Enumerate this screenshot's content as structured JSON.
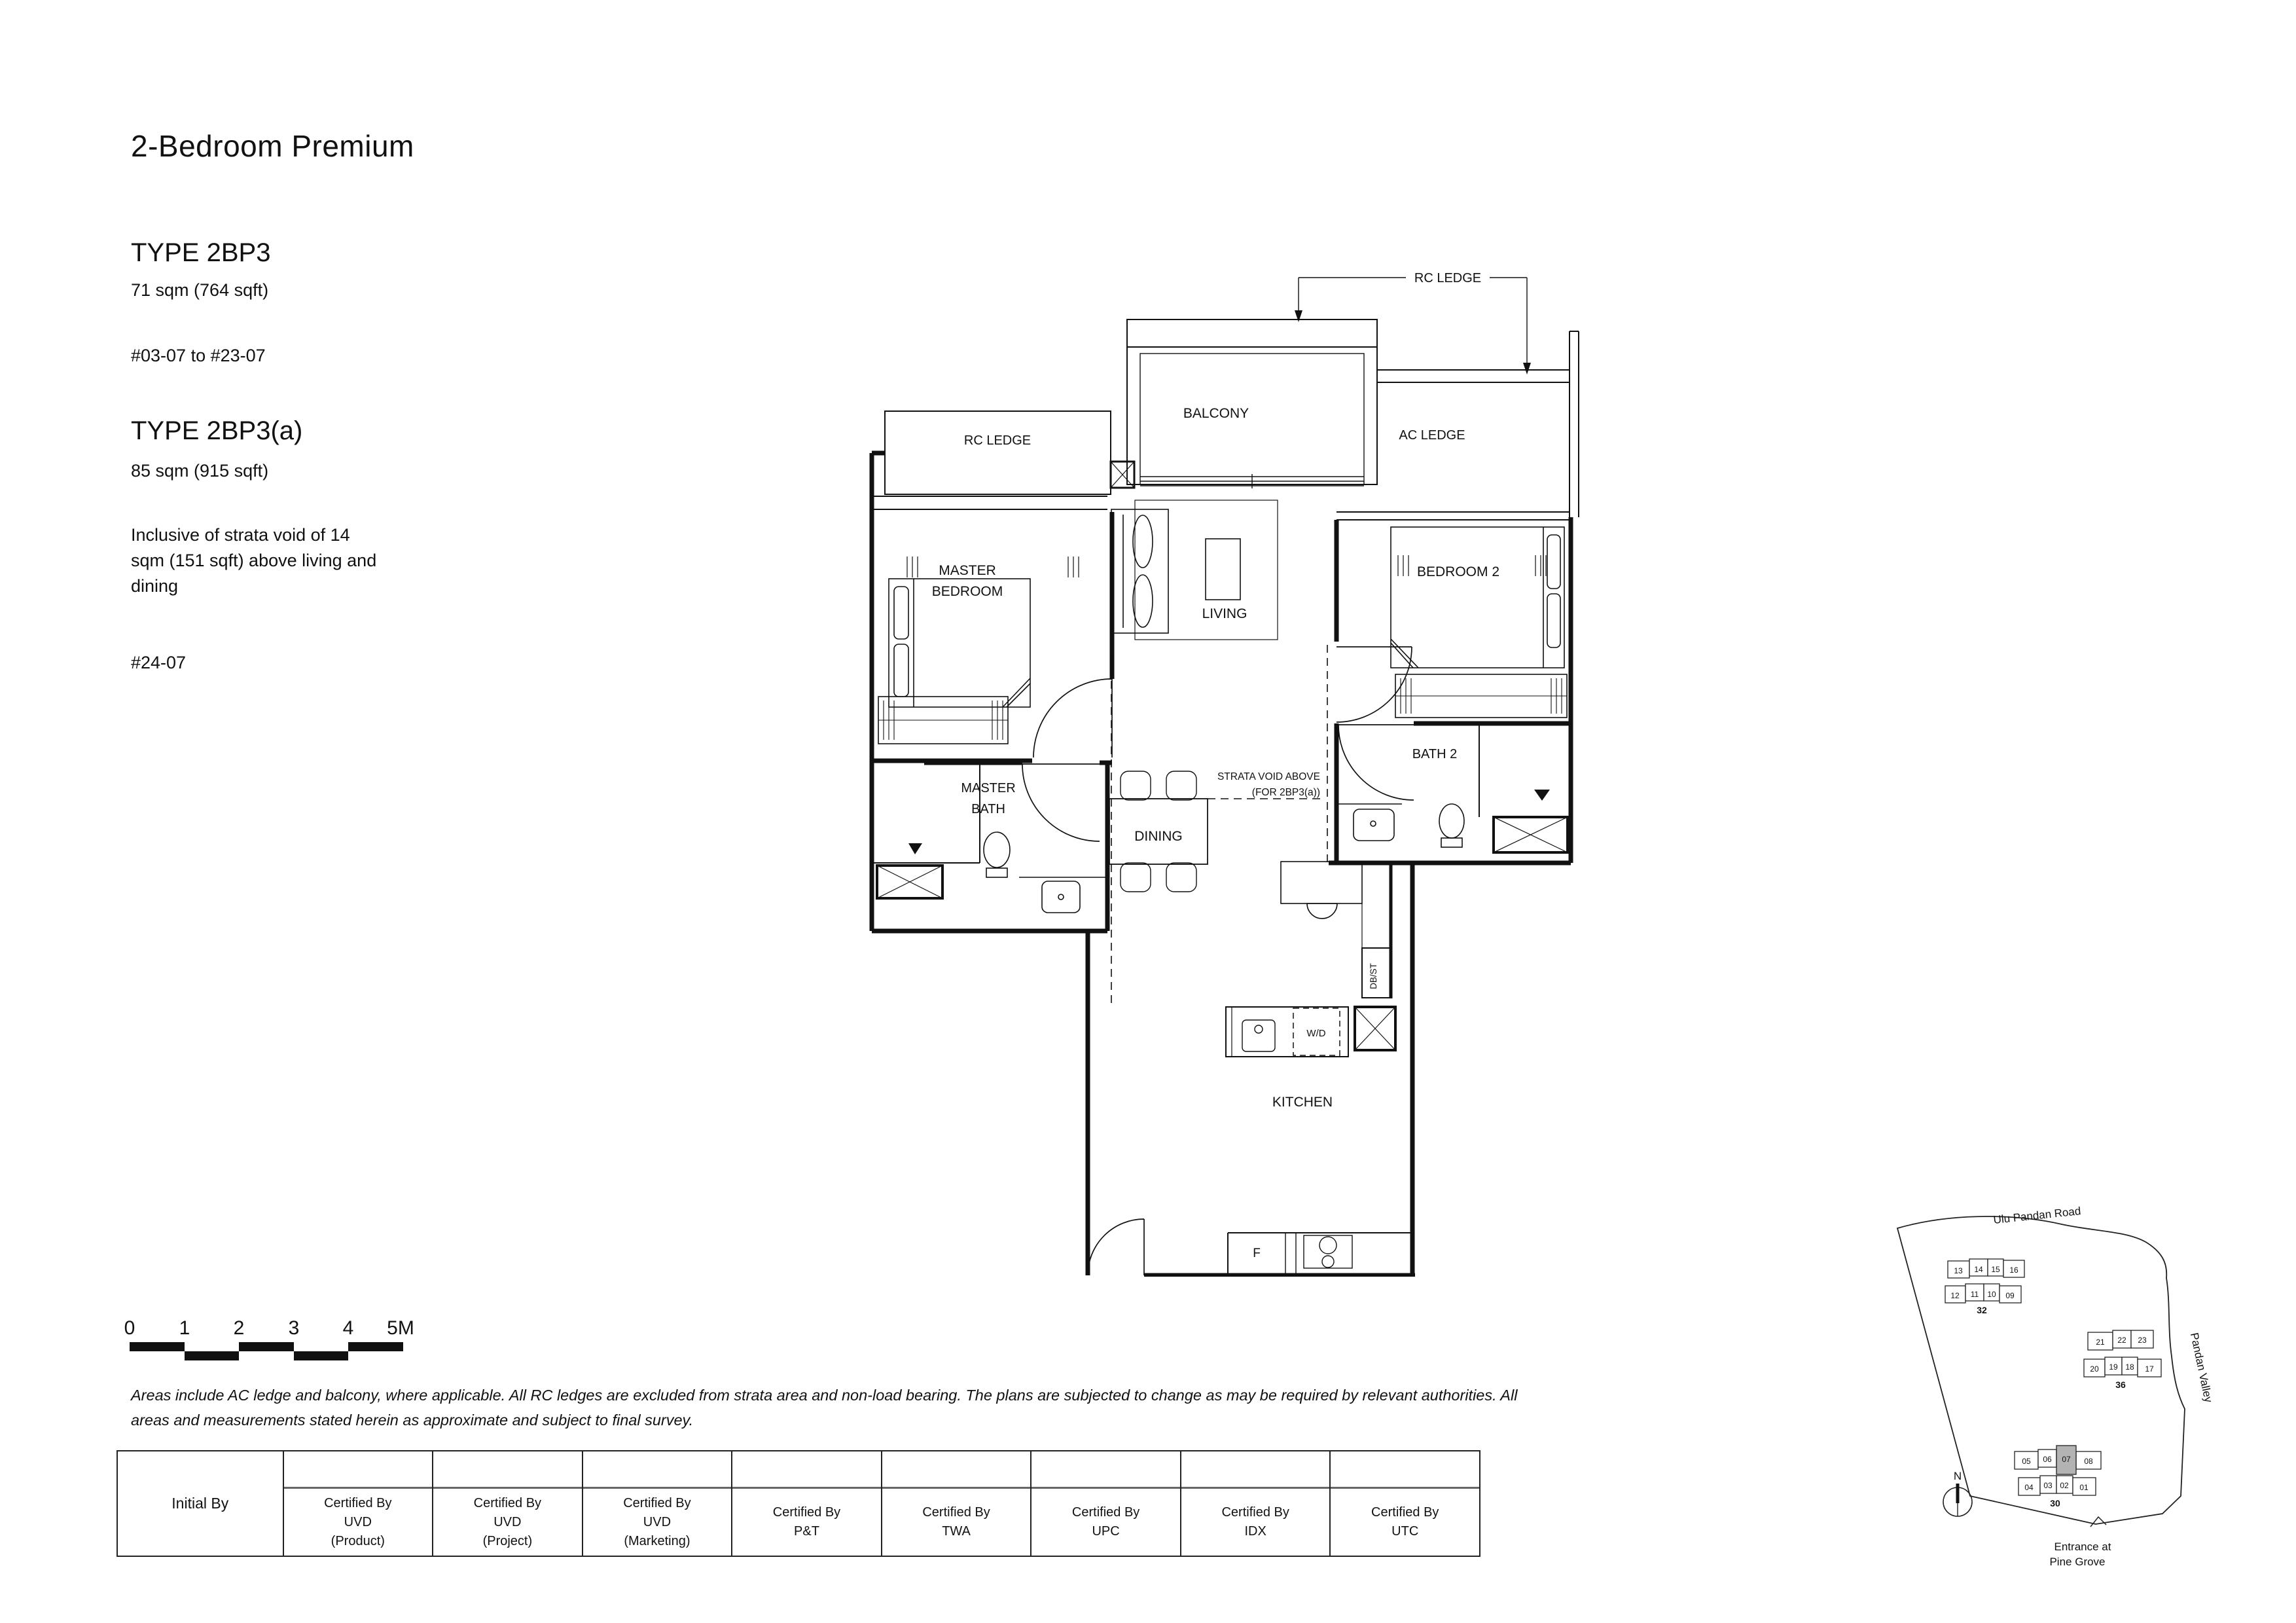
{
  "header": {
    "title": "2-Bedroom Premium"
  },
  "types": [
    {
      "name": "TYPE 2BP3",
      "area": "71 sqm (764 sqft)",
      "units": "#03-07 to #23-07"
    },
    {
      "name": "TYPE 2BP3(a)",
      "area": "85 sqm (915 sqft)",
      "note": "Inclusive of strata void of 14 sqm (151 sqft) above living and dining",
      "units": "#24-07"
    }
  ],
  "floorplan": {
    "labels": {
      "rc_ledge_top": "RC LEDGE",
      "balcony": "BALCONY",
      "rc_ledge_left": "RC LEDGE",
      "ac_ledge": "AC LEDGE",
      "master_bedroom_1": "MASTER",
      "master_bedroom_2": "BEDROOM",
      "living": "LIVING",
      "bedroom_2": "BEDROOM 2",
      "master_bath_1": "MASTER",
      "master_bath_2": "BATH",
      "bath_2": "BATH 2",
      "dining": "DINING",
      "strata_void_1": "STRATA VOID ABOVE",
      "strata_void_2": "(FOR 2BP3(a))",
      "db_st": "DB/ST",
      "wd": "W/D",
      "kitchen": "KITCHEN",
      "fridge": "F"
    }
  },
  "scalebar": {
    "labels": [
      "0",
      "1",
      "2",
      "3",
      "4",
      "5M"
    ]
  },
  "disclaimer": "Areas include AC ledge and balcony, where applicable. All RC ledges are excluded from strata area and non-load bearing. The plans are subjected to change as may be required by relevant authorities. All areas and measurements stated herein as approximate and subject to final survey.",
  "table": {
    "initial_by": "Initial By",
    "columns": [
      "Certified By\nUVD\n(Product)",
      "Certified By\nUVD\n(Project)",
      "Certified By\nUVD\n(Marketing)",
      "Certified By\nP&T",
      "Certified By\nTWA",
      "Certified By\nUPC",
      "Certified By\nIDX",
      "Certified By\nUTC"
    ]
  },
  "siteplan": {
    "road_top": "Ulu Pandan Road",
    "road_right": "Pandan Valley",
    "entrance_1": "Entrance at",
    "entrance_2": "Pine Grove",
    "north": "N",
    "highlight_color": "#b3b3b3",
    "blocks": [
      {
        "label": "32",
        "row1": [
          "13",
          "14",
          "15",
          "16"
        ],
        "row2": [
          "12",
          "11",
          "10",
          "09"
        ]
      },
      {
        "label": "36",
        "row1": [
          "21",
          "22",
          "23"
        ],
        "row2": [
          "20",
          "19",
          "18",
          "17"
        ]
      },
      {
        "label": "30",
        "row1": [
          "05",
          "06",
          "07",
          "08"
        ],
        "row2": [
          "04",
          "03",
          "02",
          "01"
        ],
        "highlighted_unit": "07"
      }
    ]
  }
}
